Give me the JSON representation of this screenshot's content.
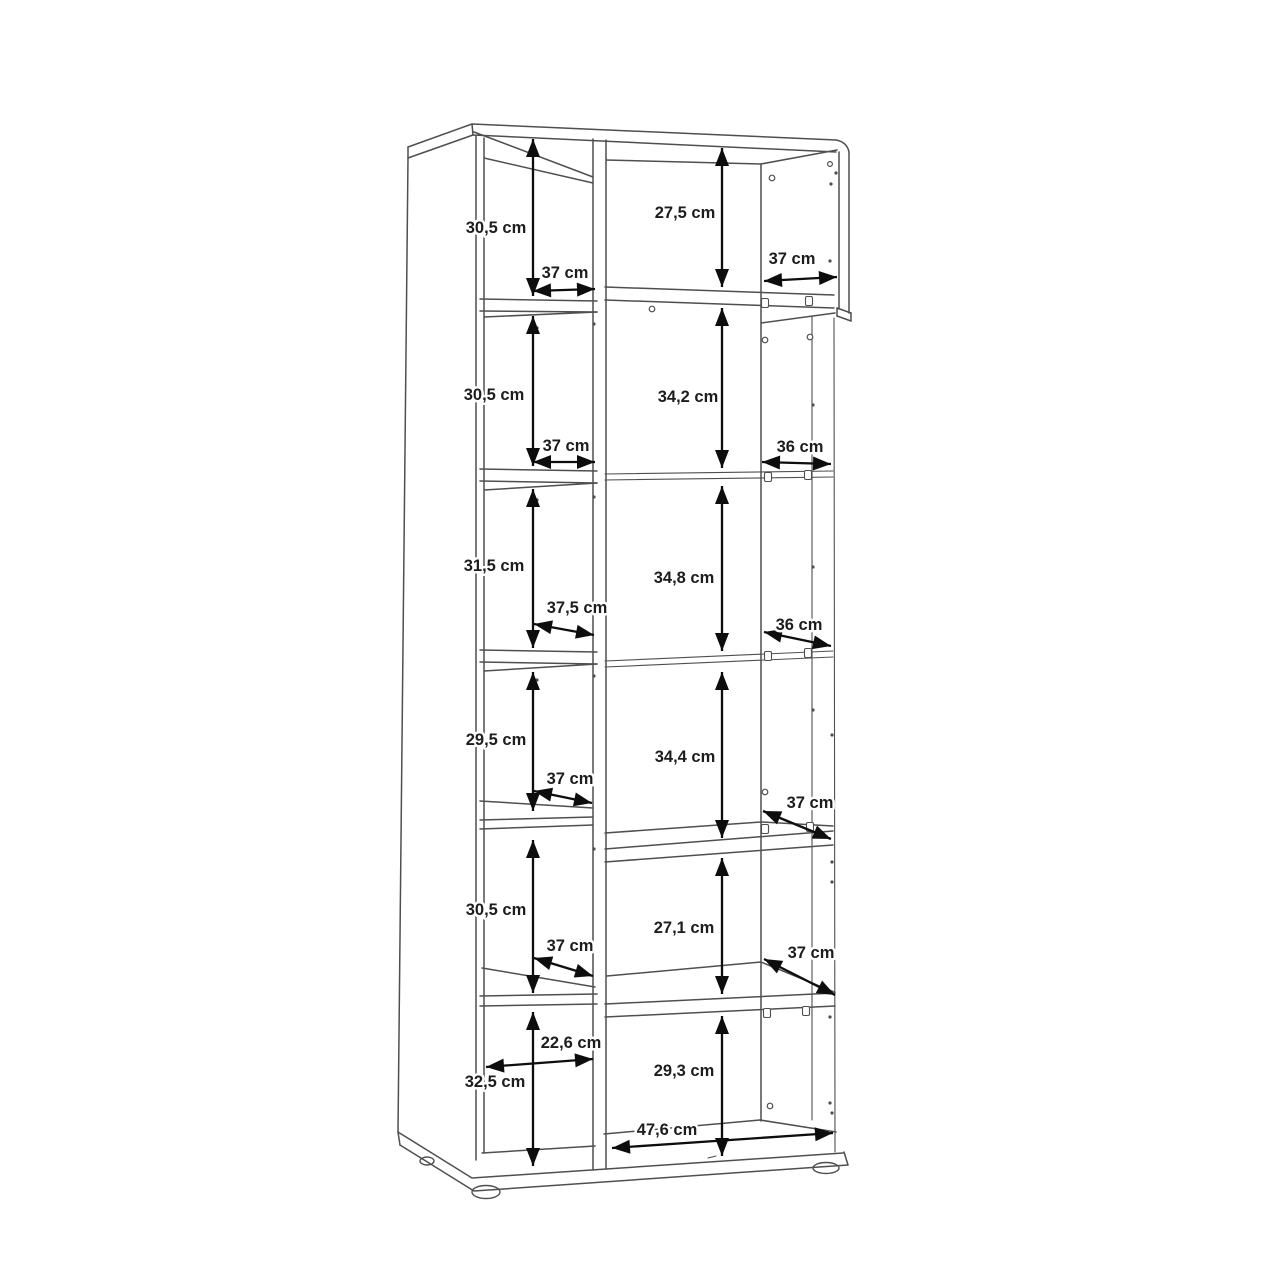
{
  "diagram": {
    "type": "furniture-dimension-drawing",
    "subject": "tall two-column shelf cabinet shown in perspective with interior compartment dimensions",
    "unit": "cm",
    "colors": {
      "background": "#ffffff",
      "cabinet_line": "#4f4f4f",
      "dimension_arrow": "#0d0d0d",
      "label_text": "#1d1d1d"
    },
    "left_column": {
      "compartments": [
        {
          "height": "30,5 cm",
          "width": "37 cm"
        },
        {
          "height": "30,5 cm",
          "width": "37 cm"
        },
        {
          "height": "31,5 cm",
          "width": "37,5 cm"
        },
        {
          "height": "29,5 cm",
          "width": "37 cm"
        },
        {
          "height": "30,5 cm",
          "width": "37 cm"
        },
        {
          "height": "32,5 cm",
          "width": "22,6 cm"
        }
      ]
    },
    "right_column": {
      "compartments": [
        {
          "height": "27,5 cm",
          "width": "37 cm"
        },
        {
          "height": "34,2 cm",
          "width": "36 cm"
        },
        {
          "height": "34,8 cm",
          "width": "36 cm"
        },
        {
          "height": "34,4 cm",
          "width": "37 cm"
        },
        {
          "height": "27,1 cm",
          "width": "37 cm"
        },
        {
          "height": "29,3 cm",
          "width": "47,6 cm"
        }
      ]
    }
  }
}
